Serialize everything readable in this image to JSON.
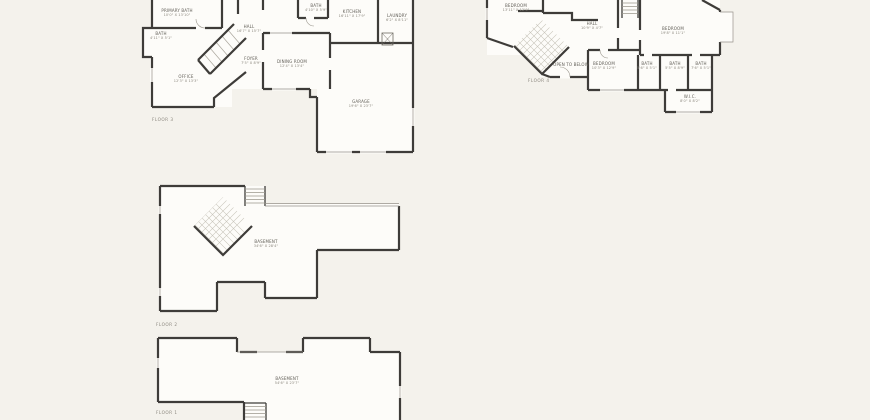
{
  "colors": {
    "background": "#f4f2ec",
    "interior": "#fdfcf9",
    "wall": "#3e3c39",
    "room_text": "#5f5c55",
    "dim_text": "#8b877e"
  },
  "floors": [
    {
      "floor_label": "FLOOR 3",
      "rooms": [
        {
          "name": "PRIMARY BATH",
          "dims": "10'0\" X 13'10\""
        },
        {
          "name": "BATH",
          "dims": "4'11\" X 5'1\""
        },
        {
          "name": "HALL",
          "dims": "16'7\" X 15'7\""
        },
        {
          "name": "BATH",
          "dims": "4'10\" X 5'9\""
        },
        {
          "name": "KITCHEN",
          "dims": "16'11\" X 17'9\""
        },
        {
          "name": "LAUNDRY",
          "dims": "6'2\" X 8'11\""
        },
        {
          "name": "FOYER",
          "dims": "7'5\" X 8'9\""
        },
        {
          "name": "DINING ROOM",
          "dims": "12'4\" X 13'4\""
        },
        {
          "name": "OFFICE",
          "dims": "12'3\" X 13'3\""
        },
        {
          "name": "GARAGE",
          "dims": "19'6\" X 23'7\""
        }
      ]
    },
    {
      "floor_label": "FLOOR 4",
      "rooms": [
        {
          "name": "BEDROOM",
          "dims": "13'11\" X 12'9\""
        },
        {
          "name": "HALL",
          "dims": "10'9\" X 4'7\""
        },
        {
          "name": "BEDROOM",
          "dims": "19'8\" X 11'1\""
        },
        {
          "name": "OPEN TO BELOW",
          "dims": ""
        },
        {
          "name": "BEDROOM",
          "dims": "10'3\" X 12'9\""
        },
        {
          "name": "BATH",
          "dims": "5'6\" X 5'1\""
        },
        {
          "name": "BATH",
          "dims": "5'5\" X 8'9\""
        },
        {
          "name": "BATH",
          "dims": "7'6\" X 5'1\""
        },
        {
          "name": "W.I.C.",
          "dims": "8'0\" X 8'2\""
        }
      ]
    },
    {
      "floor_label": "FLOOR 2",
      "rooms": [
        {
          "name": "BASEMENT",
          "dims": "34'6\" X 28'4\""
        }
      ]
    },
    {
      "floor_label": "FLOOR 1",
      "rooms": [
        {
          "name": "BASEMENT",
          "dims": "54'6\" X 23'7\""
        }
      ]
    }
  ]
}
